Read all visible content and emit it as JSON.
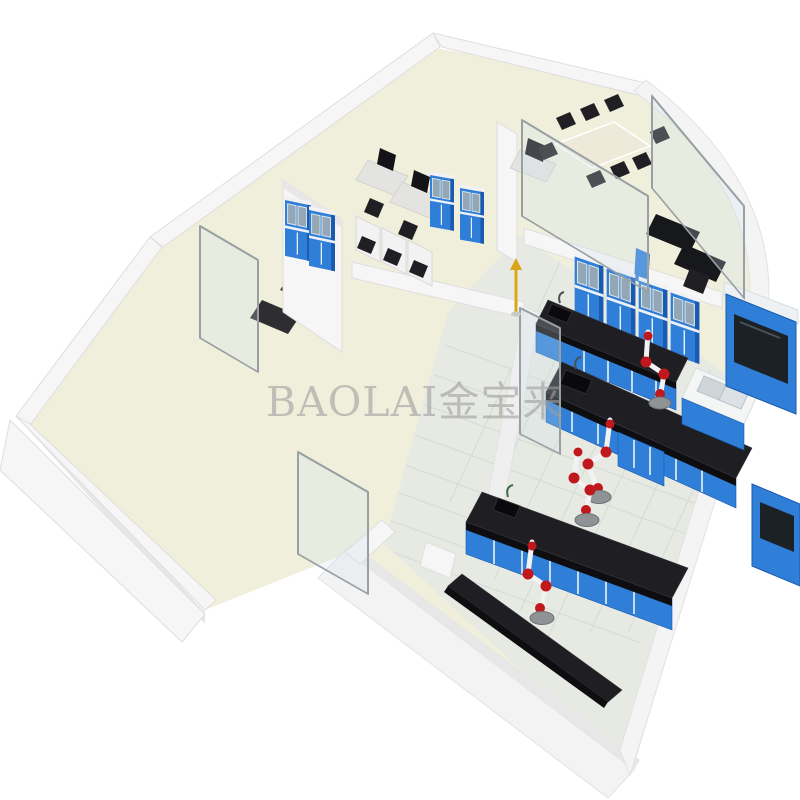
{
  "meta": {
    "title": "3D laboratory floor-plan rendering",
    "canvas": {
      "width": 800,
      "height": 800
    },
    "view": "isometric cutaway of laboratory suite, white background"
  },
  "watermark": {
    "text": "BAOLAI金宝来"
  },
  "palette": {
    "background": "#ffffff",
    "floor_cream": "#f0efdc",
    "floor_tile": "#e7eae3",
    "tile_grout": "#ccd2cc",
    "wall_light": "#f6f6f6",
    "wall_shade": "#e7e7e7",
    "wall_edge": "#dedede",
    "cabinet_blue": "#2f7fd9",
    "cabinet_blue_dark": "#1a5ab0",
    "cabinet_glass": "#93a7b5",
    "bench_top": "#1f1f23",
    "glass": "#cfe0e8",
    "frame_gray": "#98a0a4",
    "arm_red": "#c0181c",
    "arm_white": "#f2f2f2",
    "hood_gray": "#909396",
    "accent_yellow": "#d9a51a",
    "watermark_gray": "#9e9e9e"
  },
  "scene_objects": [
    {
      "name": "empty-room-left",
      "kind": "room"
    },
    {
      "name": "storage-room-top",
      "kind": "room"
    },
    {
      "name": "workstation-room",
      "kind": "room",
      "contents": [
        "computer-desks",
        "blue-glass-cabinets",
        "partition-stalls"
      ]
    },
    {
      "name": "conference-room",
      "kind": "room",
      "contents": [
        "meeting-table",
        "black-chairs",
        "glass-partitions"
      ]
    },
    {
      "name": "office-curved-wall",
      "kind": "room",
      "contents": [
        "black-desks",
        "office-chair"
      ]
    },
    {
      "name": "main-laboratory",
      "kind": "room",
      "contents": [
        "island-benches",
        "fume-extraction-arms",
        "sink-bench",
        "fume-hood",
        "blue-wall-cabinets"
      ]
    },
    {
      "name": "lab-room-bottom",
      "kind": "room",
      "contents": [
        "island-bench",
        "side-bench",
        "fume-extraction-arms"
      ]
    },
    {
      "name": "corridor",
      "kind": "circulation",
      "contents": [
        "glass-doors",
        "safety-eyewash"
      ]
    }
  ]
}
